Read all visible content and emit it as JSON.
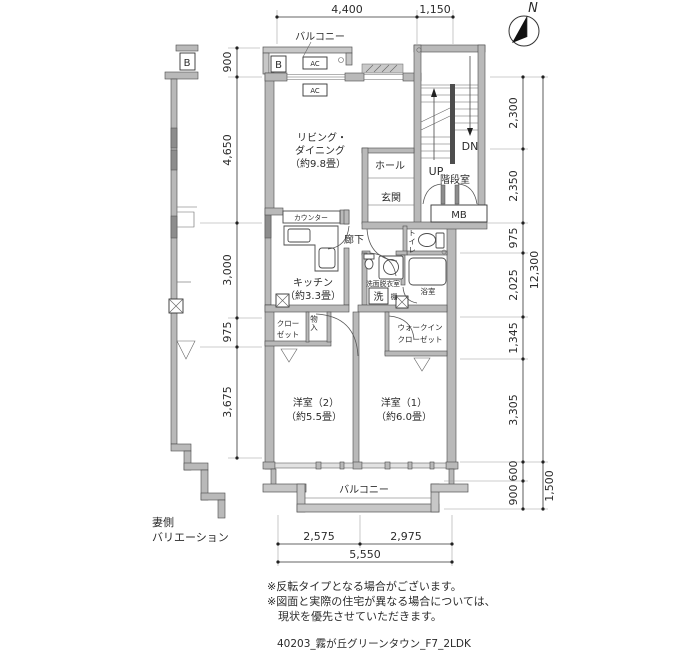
{
  "compass": {
    "north": "N"
  },
  "labels": {
    "balcony": "バルコニー",
    "living1": "リビング・",
    "living2": "ダイニング",
    "living_size": "（約9.8畳）",
    "hall": "ホール",
    "genkan": "玄関",
    "stairwell": "階段室",
    "up": "UP",
    "dn": "DN",
    "mb": "MB",
    "counter": "カウンター",
    "corridor": "廊下",
    "kitchen": "キッチン",
    "kitchen_size": "（約3.3畳）",
    "toilet": "トイレ",
    "washroom": "洗面脱衣室",
    "washer": "洗",
    "shelf": "棚",
    "bath": "浴室",
    "closet1": "クロー",
    "closet2": "ゼット",
    "storage": "物入",
    "wic1": "ウォークイン",
    "wic2": "クローゼット",
    "bedroom2": "洋室（2）",
    "bedroom2_size": "（約5.5畳）",
    "bedroom1": "洋室（1）",
    "bedroom1_size": "（約6.0畳）",
    "b": "B",
    "ac": "AC"
  },
  "dims": {
    "top": [
      "4,400",
      "1,150"
    ],
    "left": [
      "900",
      "4,650",
      "3,000",
      "975",
      "3,675"
    ],
    "right": [
      "2,300",
      "2,350",
      "975",
      "2,025",
      "1,345",
      "3,305"
    ],
    "right_total": "12,300",
    "balcony_depth": [
      "600",
      "900"
    ],
    "balcony_total": "1,500",
    "bottom": [
      "2,575",
      "2,975"
    ],
    "bottom_total": "5,550"
  },
  "side_label": {
    "line1": "妻側",
    "line2": "バリエーション"
  },
  "notes": [
    "※反転タイプとなる場合がございます。",
    "※図面と実際の住宅が異なる場合については、",
    "現状を優先させていただきます。"
  ],
  "footer": "40203_霧が丘グリーンタウン_F7_2LDK"
}
